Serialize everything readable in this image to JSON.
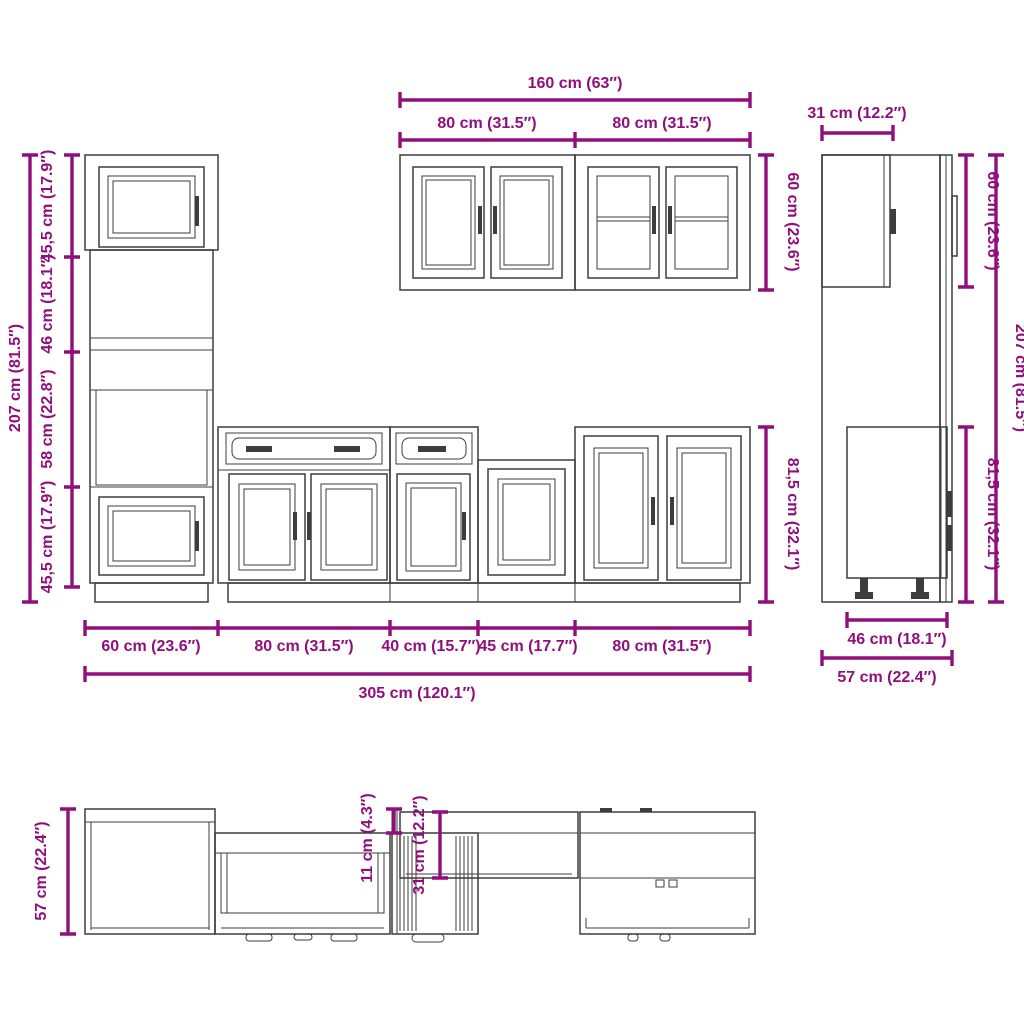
{
  "palette": {
    "dimension_color": "#910e7d",
    "line_color": "#3d3d3d",
    "background": "#ffffff"
  },
  "front_elevation": {
    "left_column": {
      "overall_height": "207 cm (81.5″)",
      "segment_top_door": "45,5 cm (17.9″)",
      "segment_open": "46 cm (18.1″)",
      "segment_oven": "58 cm (22.8″)",
      "segment_bottom_door": "45,5 cm (17.9″)"
    },
    "wall_cabinets": {
      "total_width": "160 cm (63″)",
      "left_width": "80 cm (31.5″)",
      "right_width": "80 cm (31.5″)",
      "height": "60 cm (23.6″)"
    },
    "base_cabinets": {
      "height": "81,5 cm (32.1″)",
      "width_tall_unit": "60 cm (23.6″)",
      "width_unit_2": "80 cm (31.5″)",
      "width_unit_3": "40 cm (15.7″)",
      "width_unit_4": "45 cm (17.7″)",
      "width_unit_5": "80 cm (31.5″)",
      "total_width": "305 cm (120.1″)"
    }
  },
  "side_view": {
    "wall_cabinet_depth": "31 cm (12.2″)",
    "wall_cabinet_height": "60 cm (23.6″)",
    "overall_height": "207 cm (81.5″)",
    "base_height": "81,5 cm (32.1″)",
    "base_depth": "46 cm (18.1″)",
    "total_depth": "57 cm (22.4″)"
  },
  "plan_view": {
    "total_depth": "57 cm (22.4″)",
    "depth_difference": "11 cm (4.3″)",
    "shallow_depth": "31 cm (12.2″)"
  }
}
